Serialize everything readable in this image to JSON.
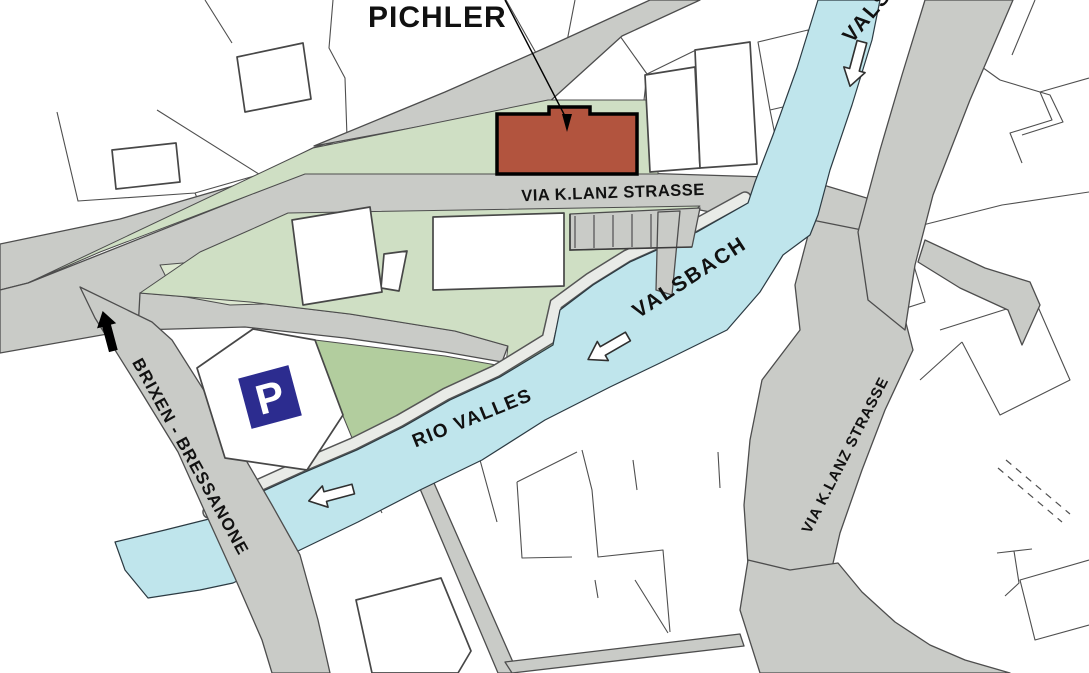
{
  "map": {
    "labels": {
      "pichler": "PICHLER",
      "street_main": "VIA K.LANZ STRASSE",
      "river_main": "VALSBACH",
      "river_main_upper": "VALSBACH",
      "river_secondary": "RIO VALLES",
      "road_brixen": "BRIXEN - BRESSANONE",
      "street_right": "VIA K.LANZ STRASSE",
      "parking": "P"
    },
    "colors": {
      "road": "#c9cbc7",
      "river": "#bfe5ec",
      "green_light": "#cfdfc4",
      "green_dark": "#b2cd9e",
      "green_pale": "#dde8d1",
      "highlight_building": "#b2543e",
      "building_fill": "#ffffff",
      "parking_blue": "#2c2c8f",
      "path_light": "#e9ebe7",
      "label_text": "#111111"
    },
    "icons": {
      "parking": "parking-icon",
      "river_flow": "river-flow-arrow",
      "road_direction": "road-direction-arrow"
    }
  }
}
